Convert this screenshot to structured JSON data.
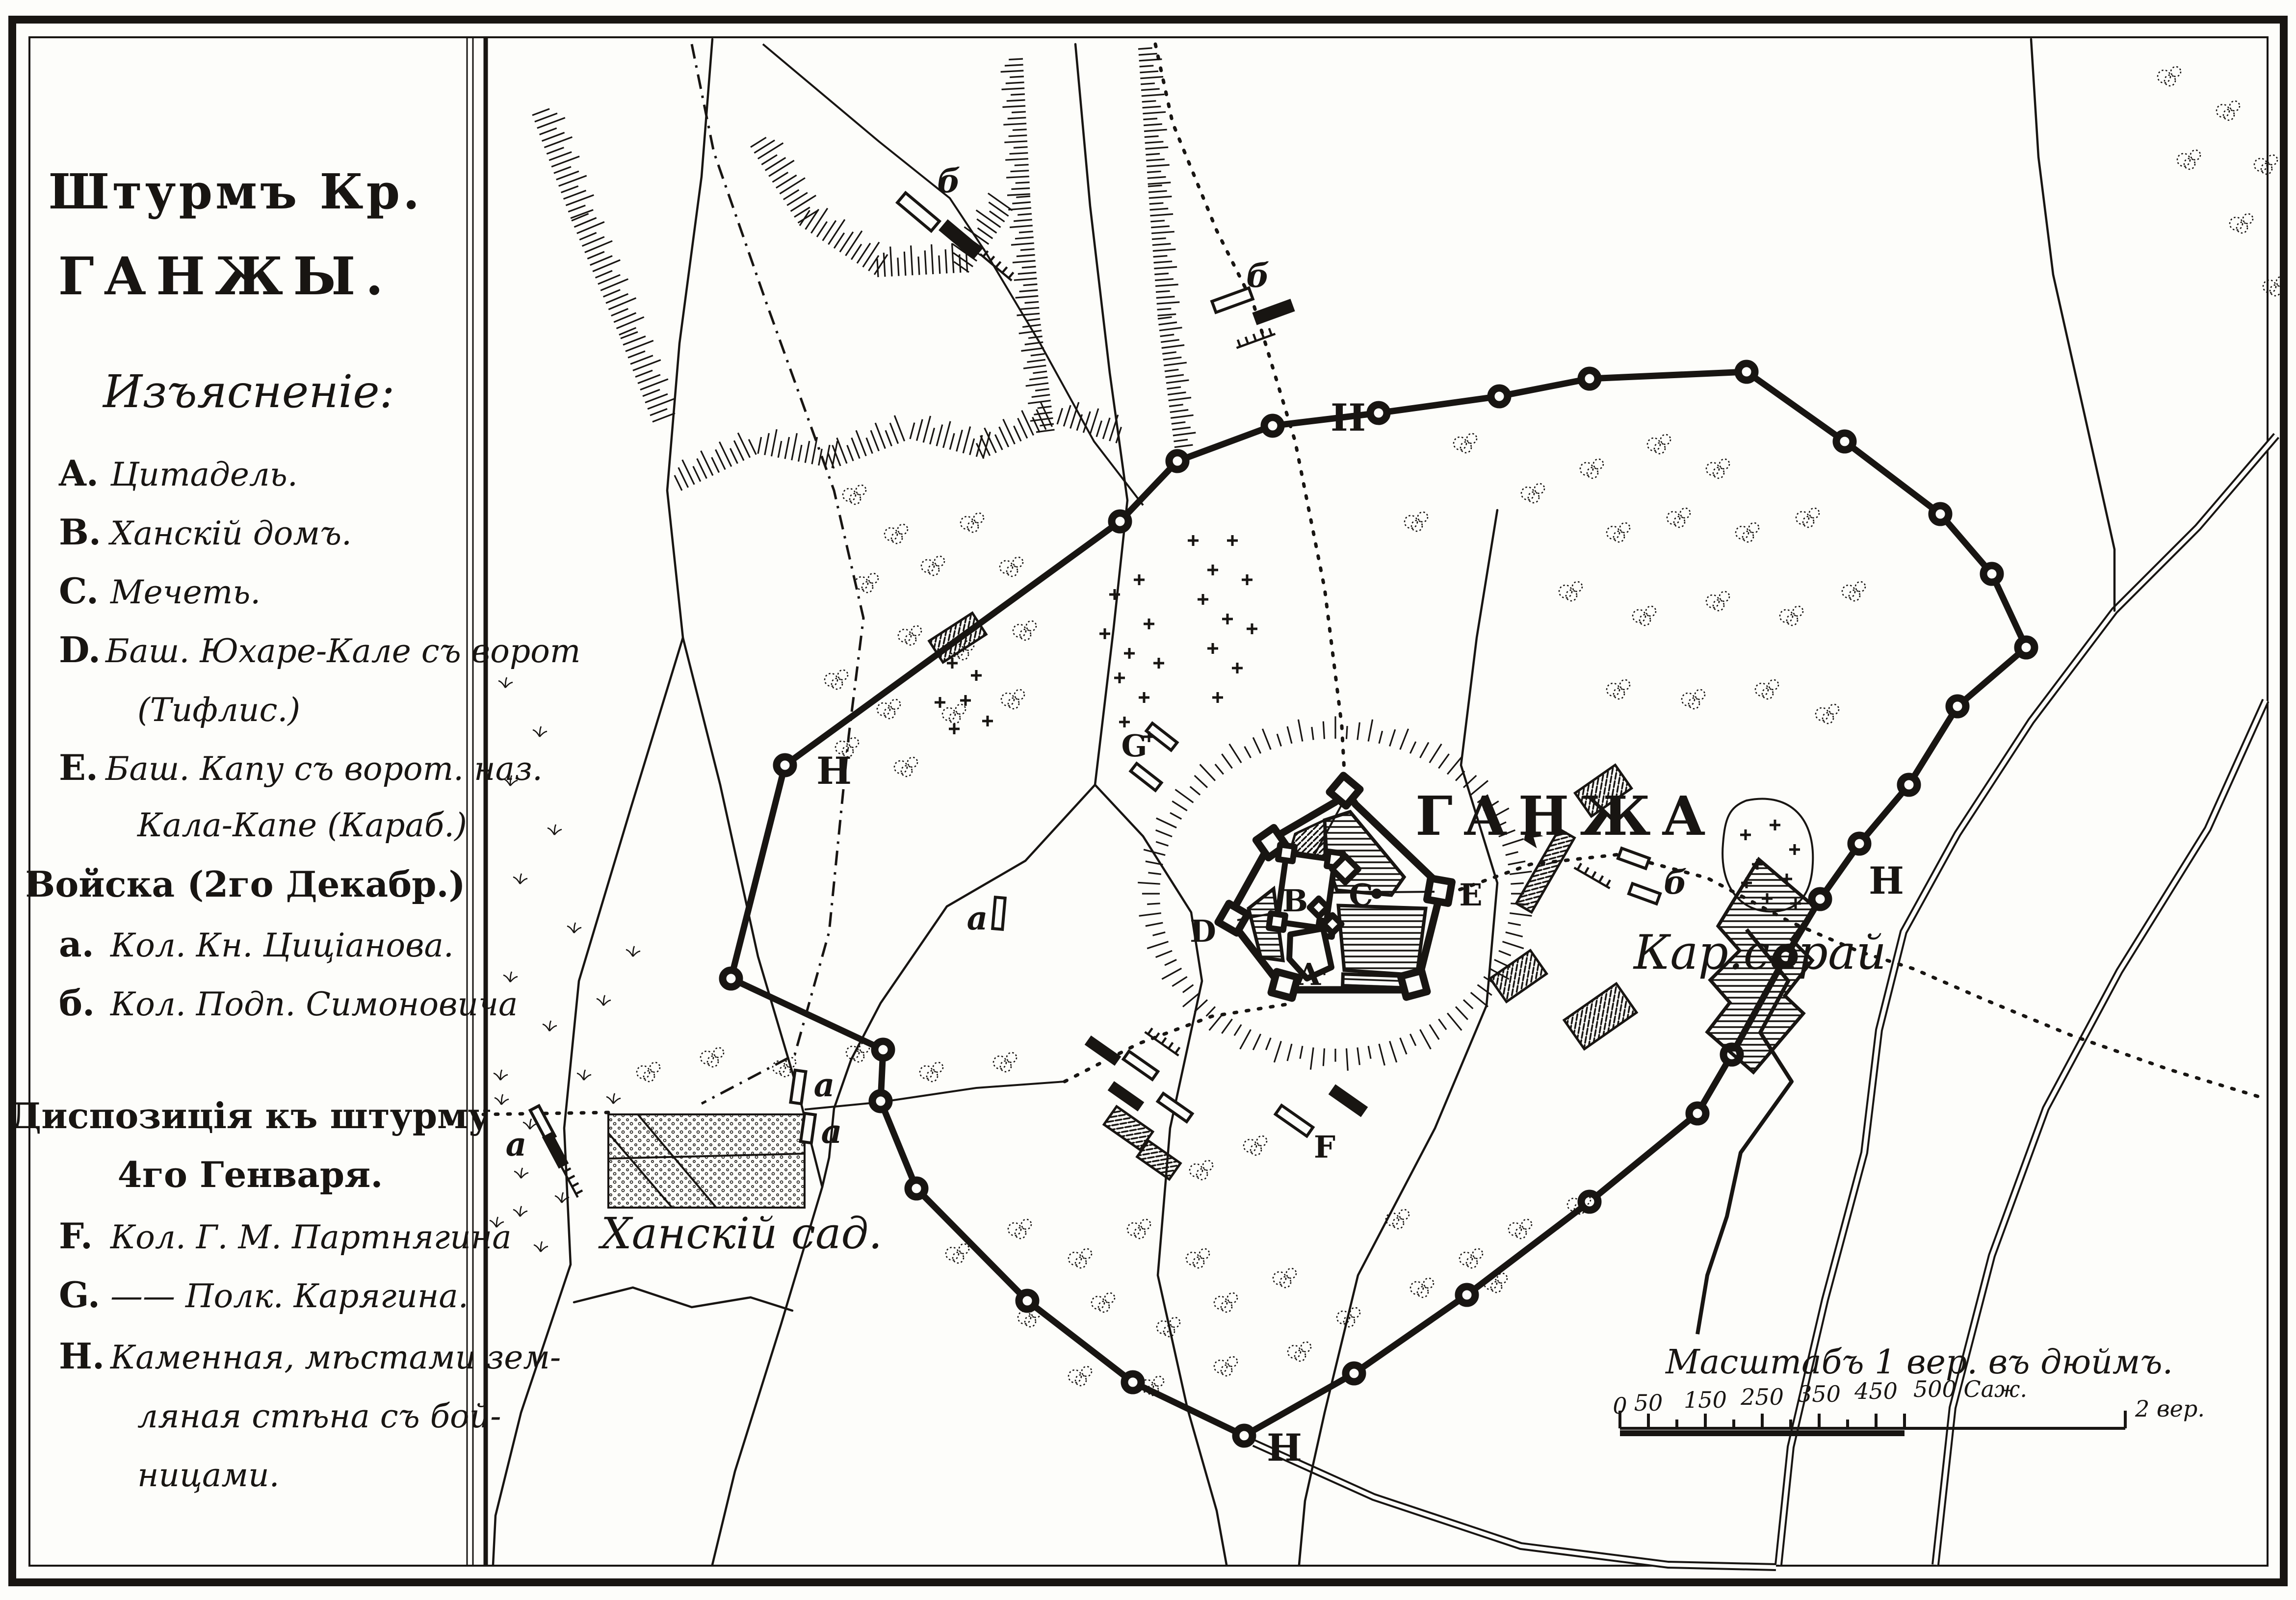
{
  "sheet": {
    "title": [
      "Штурмъ Кр.",
      "ГАНЖЫ."
    ],
    "legend_heading": "Изъясненіе:",
    "legend": [
      {
        "key": "A.",
        "text": "Цитадель."
      },
      {
        "key": "B.",
        "text": "Ханскій домъ."
      },
      {
        "key": "C.",
        "text": "Мечеть."
      },
      {
        "key": "D.",
        "text": "Баш. Юхаре-Кале съ ворот"
      },
      {
        "key": "",
        "text": "(Тифлис.)"
      },
      {
        "key": "E.",
        "text": "Баш. Капу съ ворот. наз."
      },
      {
        "key": "",
        "text": "Кала-Капе (Караб.)"
      },
      {
        "key": "",
        "text": "Войска (2го Декабр.)"
      },
      {
        "key": "а.",
        "text": "Кол. Кн. Циціанова."
      },
      {
        "key": "б.",
        "text": "Кол. Подп. Симоновича"
      },
      {
        "key": "",
        "text": "Диспозиція къ штурму"
      },
      {
        "key": "",
        "text": "4го Генваря."
      },
      {
        "key": "F.",
        "text": "Кол. Г. М. Партнягина"
      },
      {
        "key": "G.",
        "text": "—— Полк. Карягина."
      },
      {
        "key": "H.",
        "text": "Каменная, мѣстами зем-"
      },
      {
        "key": "",
        "text": "ляная стѣна съ бой-"
      },
      {
        "key": "",
        "text": "ницами."
      }
    ]
  },
  "map": {
    "city": "ГАНЖА",
    "caravanserai": "Кар.сарай",
    "khans_garden": "Ханскій сад.",
    "wall": "Н",
    "forts": {
      "A": "A",
      "B": "B",
      "C": "C",
      "D": "D",
      "E": "E"
    },
    "units": {
      "a": "а",
      "b": "б",
      "F": "F",
      "G": "G"
    }
  },
  "scale": {
    "caption": "Масштабъ 1 вер. въ дюймъ.",
    "ticks": [
      "0",
      "50",
      "150",
      "250",
      "350",
      "450",
      "500 Саж."
    ],
    "end": "2 вер."
  }
}
